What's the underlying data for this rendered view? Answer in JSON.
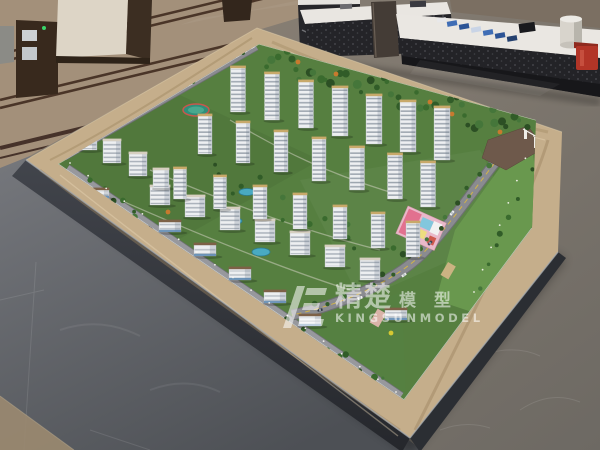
{
  "image": {
    "description": "Photograph of an architectural scale model of a residential high-rise development displayed on a marble-rimmed table in a showroom lobby, with sales counters behind and marble floors around"
  },
  "watermark": {
    "cn_primary": "精楚",
    "cn_secondary": "模 型",
    "en": "KINGSUNMODEL",
    "color": "rgba(255,255,255,0.55)"
  },
  "palette": {
    "floor_top_beige": "#a3907a",
    "floor_stripe": "#4a3528",
    "table_rim": "#c5ae8b",
    "rim_vein": "#9b835f",
    "lawn": "#567f40",
    "lawn_light": "#69984e",
    "lawn_front": "#558041",
    "road": "#8a8b90",
    "road_casing": "#6e6f74",
    "road_dash_white": "#f2f0e8",
    "road_dash_yellow": "#d9b840",
    "building_white": "#edeff1",
    "building_side": "#c7ccd3",
    "roof_gold": "#c8a96a",
    "roof_flat": "#d6cfc0",
    "roof_brown": "#7d6147",
    "shop_band": "#5b87b0",
    "tree_orange": "#c77a2e",
    "pool_blue": "#49aac2",
    "flower_red": "#c23b36",
    "light_dot": "#f7f6ef",
    "counter_top": "#e9e6e1",
    "counter_front": "#242428",
    "red_bin": "#b23527",
    "brochure_blue": "#3f6db5"
  },
  "scene": {
    "tree_colors": [
      "#2c4f24",
      "#3a6b2e",
      "#315c28",
      "#45763a"
    ],
    "towers": [
      [
        238,
        112,
        15,
        44
      ],
      [
        272,
        120,
        15,
        46
      ],
      [
        306,
        128,
        15,
        46
      ],
      [
        340,
        136,
        16,
        48
      ],
      [
        374,
        144,
        16,
        48
      ],
      [
        408,
        152,
        16,
        50
      ],
      [
        442,
        160,
        16,
        52
      ],
      [
        205,
        154,
        14,
        38
      ],
      [
        243,
        163,
        14,
        40
      ],
      [
        281,
        172,
        14,
        40
      ],
      [
        319,
        181,
        14,
        42
      ],
      [
        357,
        190,
        15,
        42
      ],
      [
        395,
        199,
        15,
        44
      ],
      [
        428,
        207,
        15,
        44
      ],
      [
        180,
        199,
        13,
        30
      ],
      [
        220,
        209,
        13,
        32
      ],
      [
        260,
        219,
        14,
        32
      ],
      [
        300,
        229,
        14,
        34
      ],
      [
        340,
        239,
        14,
        32
      ],
      [
        378,
        248,
        14,
        34
      ],
      [
        413,
        257,
        14,
        34
      ]
    ],
    "midrise": [
      [
        160,
        205,
        20,
        18
      ],
      [
        195,
        217,
        20,
        20
      ],
      [
        230,
        230,
        20,
        21
      ],
      [
        265,
        242,
        20,
        21
      ],
      [
        300,
        255,
        20,
        22
      ],
      [
        335,
        267,
        20,
        20
      ],
      [
        370,
        280,
        20,
        20
      ],
      [
        88,
        150,
        18,
        20
      ],
      [
        112,
        163,
        18,
        22
      ],
      [
        138,
        176,
        18,
        22
      ],
      [
        161,
        188,
        16,
        18
      ]
    ],
    "lowrise": [
      [
        170,
        232,
        22,
        10
      ],
      [
        205,
        256,
        22,
        11
      ],
      [
        240,
        280,
        22,
        11
      ],
      [
        275,
        303,
        22,
        11
      ],
      [
        310,
        326,
        22,
        10
      ],
      [
        396,
        320,
        22,
        10
      ],
      [
        100,
        198,
        18,
        8
      ]
    ],
    "tree_belts": [
      {
        "x1": 66,
        "y1": 150,
        "x2": 252,
        "y2": 42,
        "count": 24,
        "spread": 5,
        "rmin": 1.5,
        "rmax": 3
      },
      {
        "x1": 264,
        "y1": 58,
        "x2": 528,
        "y2": 130,
        "count": 44,
        "spread": 13,
        "rmin": 2,
        "rmax": 4.5
      },
      {
        "x1": 80,
        "y1": 175,
        "x2": 150,
        "y2": 232,
        "count": 12,
        "spread": 9,
        "rmin": 1.5,
        "rmax": 3.2
      },
      {
        "x1": 120,
        "y1": 228,
        "x2": 392,
        "y2": 392,
        "count": 32,
        "spread": 9,
        "rmin": 1.5,
        "rmax": 3.4
      },
      {
        "x1": 200,
        "y1": 160,
        "x2": 400,
        "y2": 272,
        "count": 24,
        "spread": 24,
        "rmin": 1.6,
        "rmax": 3.2
      },
      {
        "x1": 494,
        "y1": 165,
        "x2": 420,
        "y2": 255,
        "count": 9,
        "spread": 7,
        "rmin": 1.6,
        "rmax": 3
      },
      {
        "x1": 415,
        "y1": 258,
        "x2": 295,
        "y2": 320,
        "count": 9,
        "spread": 7,
        "rmin": 1.6,
        "rmax": 3
      },
      {
        "x1": 540,
        "y1": 150,
        "x2": 475,
        "y2": 295,
        "count": 8,
        "spread": 6,
        "rmin": 1.6,
        "rmax": 3
      }
    ],
    "orange_trees": [
      [
        298,
        62
      ],
      [
        336,
        74
      ],
      [
        430,
        102
      ],
      [
        452,
        114
      ],
      [
        500,
        132
      ],
      [
        168,
        212
      ],
      [
        120,
        236
      ]
    ],
    "flowers": {
      "x1": 125,
      "y1": 235,
      "x2": 385,
      "y2": 388,
      "count": 10,
      "spread": 7
    },
    "lights": [
      {
        "x1": 70,
        "y1": 163,
        "x2": 396,
        "y2": 392,
        "count": 19
      },
      {
        "x1": 60,
        "y1": 150,
        "x2": 252,
        "y2": 42,
        "count": 13
      },
      {
        "x1": 534,
        "y1": 136,
        "x2": 474,
        "y2": 292,
        "count": 8
      }
    ],
    "pools": [
      [
        247,
        192,
        8,
        3.5
      ],
      [
        261,
        252,
        9,
        4
      ],
      [
        236,
        221,
        6,
        3
      ]
    ],
    "cars": [
      [
        100,
        135,
        -30
      ],
      [
        118,
        125,
        -30
      ],
      [
        136,
        114,
        -30
      ],
      [
        154,
        104,
        -30
      ],
      [
        172,
        94,
        -30
      ],
      [
        190,
        84,
        -30
      ],
      [
        150,
        228,
        35
      ],
      [
        240,
        290,
        35
      ],
      [
        310,
        338,
        35
      ],
      [
        452,
        213,
        -50
      ],
      [
        430,
        243,
        -46
      ],
      [
        404,
        275,
        -35
      ],
      [
        360,
        298,
        -22
      ],
      [
        320,
        310,
        -12
      ]
    ],
    "car_colors": [
      "#f4f4f2",
      "#2f3540",
      "#b23527",
      "#d9d9d6",
      "#50607a",
      "#f4f4f2",
      "#23252b",
      "#c5c8cc",
      "#b23527",
      "#eceff1",
      "#394355",
      "#e8e8e6",
      "#f4f4f2",
      "#303641"
    ]
  }
}
